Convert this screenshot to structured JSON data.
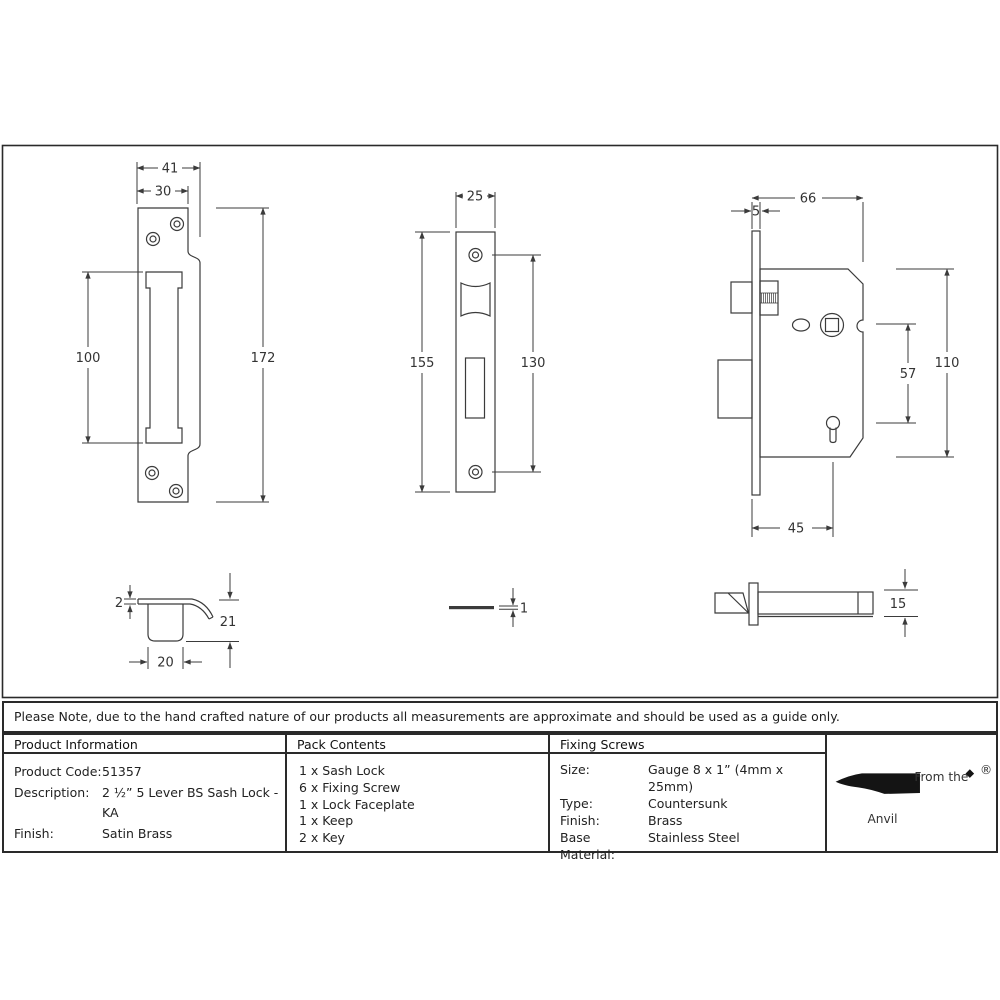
{
  "note": "Please Note, due to the hand crafted nature of our products all measurements are approximate and should be used as a guide only.",
  "drawings": {
    "keep_front": {
      "dims": {
        "overall_width": "41",
        "plate_width": "30",
        "slot_height": "100",
        "height": "172"
      }
    },
    "faceplate_front": {
      "dims": {
        "width": "25",
        "height": "155",
        "screw_centres": "130"
      }
    },
    "lock_side": {
      "dims": {
        "depth": "66",
        "faceplate_thickness": "5",
        "height": "110",
        "follower_to_key": "57",
        "backset": "45"
      }
    },
    "keep_side": {
      "dims": {
        "thickness": "2",
        "height": "21",
        "width": "20"
      }
    },
    "faceplate_side": {
      "dims": {
        "thickness": "1"
      }
    },
    "lock_top": {
      "dims": {
        "thickness": "15"
      }
    }
  },
  "table": {
    "product_information": {
      "title": "Product Information",
      "rows": [
        {
          "label": "Product Code:",
          "value": "51357"
        },
        {
          "label": "Description:",
          "value": "2 ½” 5 Lever BS Sash Lock - KA"
        },
        {
          "label": "Finish:",
          "value": "Satin Brass"
        }
      ]
    },
    "pack_contents": {
      "title": "Pack Contents",
      "items": [
        "1 x Sash Lock",
        "6 x Fixing Screw",
        "1 x Lock Faceplate",
        "1 x Keep",
        "2 x Key"
      ]
    },
    "fixing_screws": {
      "title": "Fixing Screws",
      "rows": [
        {
          "label": "Size:",
          "value": "Gauge 8 x 1” (4mm x 25mm)"
        },
        {
          "label": "Type:",
          "value": "Countersunk"
        },
        {
          "label": "Finish:",
          "value": "Brass"
        },
        {
          "label": "Base Material:",
          "value": "Stainless Steel"
        }
      ]
    }
  },
  "logo": {
    "tagline": "From the",
    "name": "Anvil",
    "registered": "®"
  },
  "colors": {
    "line": "#3b3b3b",
    "border": "#2a2a2a",
    "text": "#1e1e1e"
  }
}
